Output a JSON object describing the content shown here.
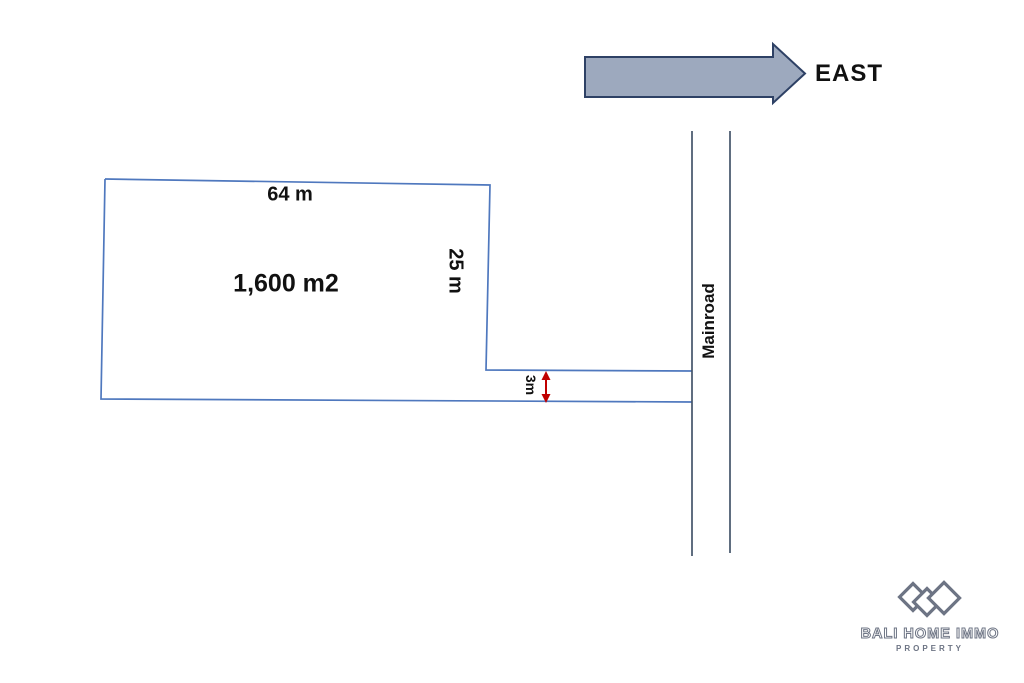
{
  "compass": {
    "label": "EAST",
    "direction": "east-right-arrow"
  },
  "plot": {
    "area_label": "1,600 m2",
    "top_dimension": "64 m",
    "right_dimension": "25 m",
    "access_strip_width": "3m"
  },
  "road": {
    "label": "Mainroad"
  },
  "logo": {
    "title": "BALI HOME IMMO",
    "subtitle": "PROPERTY",
    "icon": "three-diamonds-icon"
  },
  "colors": {
    "plot_outline": "#4f78be",
    "road_line": "#44546a",
    "dimension_red": "#c00000",
    "arrow_fill": "#9da9be",
    "arrow_stroke": "#2e4165",
    "logo_gray": "#6d7484",
    "text": "#111111",
    "background": "#ffffff"
  }
}
